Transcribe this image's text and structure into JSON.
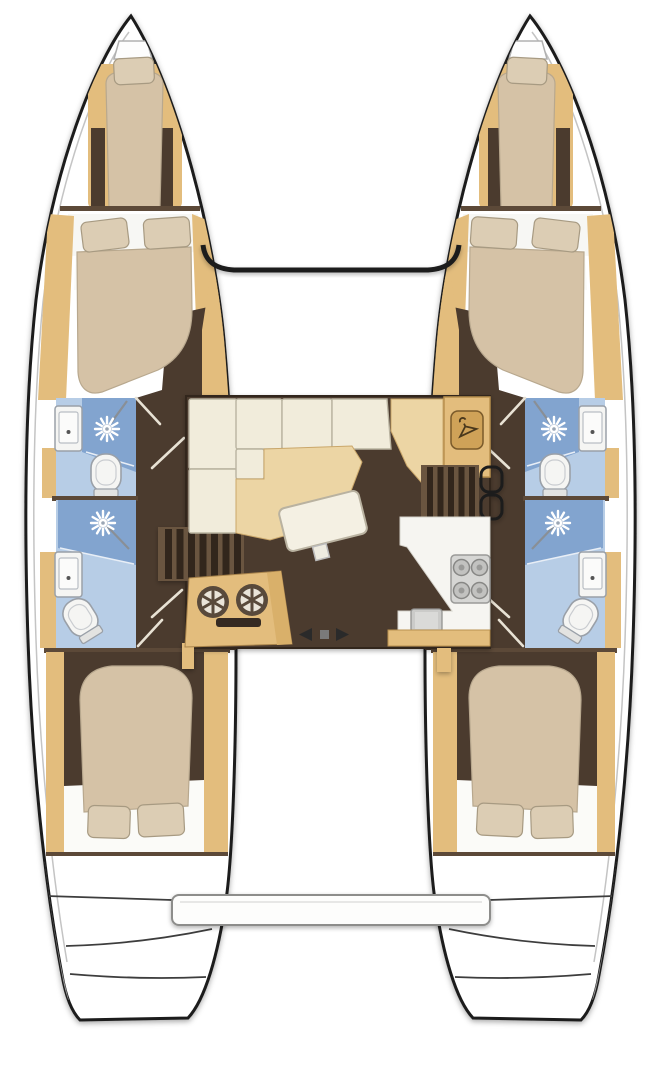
{
  "document": {
    "title": "Catamaran interior layout plan — top-down deck view",
    "type": "boat floor plan",
    "visible_text": []
  },
  "palette": {
    "outline": "#1b1b1b",
    "hull_fill": "#ffffff",
    "floor_dark": "#4b3a2f",
    "floor_darker": "#33281f",
    "wood": "#e3bd7d",
    "wood_light": "#ecd5a4",
    "wood_deep": "#cfa258",
    "bed": "#d5c2a6",
    "pillow": "#dccdb4",
    "cushion_cream": "#f1ecdb",
    "bath_blue_light": "#b7cde6",
    "bath_blue_med": "#82a4cf",
    "fixture_white": "#f5f5f3",
    "fixture_stroke": "#9aa0a8",
    "counter_white": "#f6f5f1",
    "stove_gray": "#d6d6d4",
    "burner_gray": "#c2c2c0",
    "bench_white": "#fdfdfc",
    "bulkhead": "#5c4a38",
    "tread_dark": "#33281f",
    "tread_base": "#6b5440",
    "door_leaf": "#e8e2d4"
  },
  "vessel": {
    "type": "sailing catamaran",
    "hulls": [
      {
        "id": "port",
        "rooms": [
          {
            "name": "bow anchor locker",
            "icon": "anchor-hatch-icon"
          },
          {
            "name": "forepeak crew berth",
            "berths": 1,
            "pillows": 1
          },
          {
            "name": "forward double cabin",
            "berths": 1,
            "pillows": 2
          },
          {
            "name": "forward bathroom",
            "fixtures": [
              "shower-head-icon",
              "toilet-icon",
              "sink-icon"
            ]
          },
          {
            "name": "aft bathroom",
            "fixtures": [
              "shower-head-icon",
              "toilet-icon",
              "sink-icon"
            ]
          },
          {
            "name": "aft double cabin",
            "berths": 1,
            "pillows": 2
          },
          {
            "name": "transom swim steps"
          }
        ]
      },
      {
        "id": "starboard",
        "rooms": [
          {
            "name": "bow anchor locker",
            "icon": "anchor-hatch-icon"
          },
          {
            "name": "forepeak crew berth",
            "berths": 1,
            "pillows": 1
          },
          {
            "name": "forward double cabin",
            "berths": 1,
            "pillows": 2
          },
          {
            "name": "forward bathroom",
            "fixtures": [
              "shower-head-icon",
              "toilet-icon",
              "sink-icon"
            ]
          },
          {
            "name": "aft bathroom",
            "fixtures": [
              "shower-head-icon",
              "toilet-icon",
              "sink-icon"
            ]
          },
          {
            "name": "aft double cabin",
            "berths": 1,
            "pillows": 2
          },
          {
            "name": "transom swim steps"
          }
        ]
      }
    ],
    "saloon": {
      "settee": {
        "type": "L-shaped",
        "cushion_count": 6
      },
      "table": {
        "shape": "rectangle",
        "tilted": true
      },
      "wardrobe": {
        "icon": "hanger-icon"
      },
      "galley_counter": {
        "stove_burners": 4,
        "sinks": 1,
        "icon": "stove-burner-icon"
      },
      "sink_console": {
        "round_basins": 2,
        "oven_slot": 1
      },
      "companionways": [
        {
          "side": "port",
          "treads": 7
        },
        {
          "side": "starboard",
          "treads": 5
        }
      ],
      "cockpit_door": {
        "type": "sliding",
        "icons": [
          "slide-arrow-left-icon",
          "slide-arrow-right-icon"
        ]
      }
    },
    "structure": {
      "forward_crossbeam": true,
      "aft_bench_platform": true,
      "transom_steps_per_hull": 3
    }
  }
}
